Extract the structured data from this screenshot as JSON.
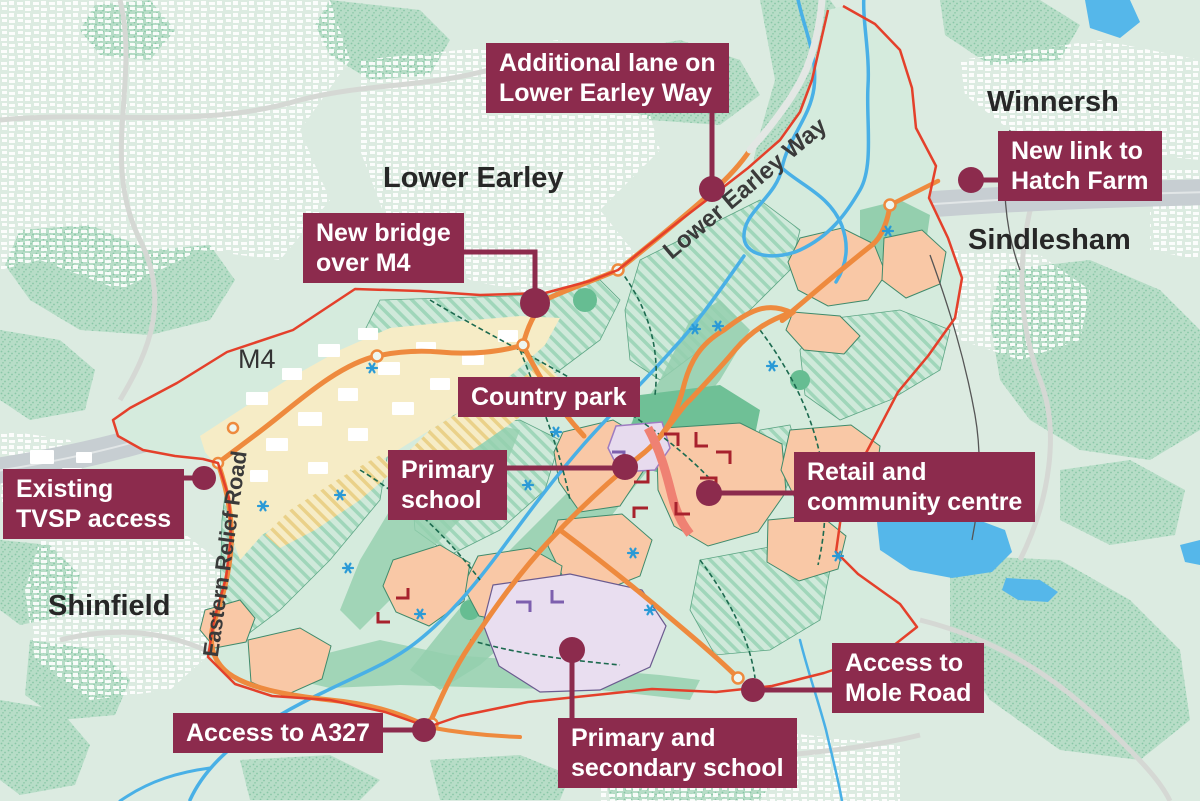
{
  "map_title": "Development site plan between Shinfield, Lower Earley, Winnersh and Sindlesham",
  "annotations": [
    {
      "id": "additional-lane",
      "lines": [
        "Additional lane on",
        "Lower Earley Way"
      ]
    },
    {
      "id": "new-bridge-m4",
      "lines": [
        "New bridge",
        "over M4"
      ]
    },
    {
      "id": "new-link-hatch-farm",
      "lines": [
        "New link to",
        "Hatch Farm"
      ]
    },
    {
      "id": "country-park",
      "lines": [
        "Country park"
      ]
    },
    {
      "id": "primary-school",
      "lines": [
        "Primary",
        "school"
      ]
    },
    {
      "id": "retail-community-centre",
      "lines": [
        "Retail and",
        "community centre"
      ]
    },
    {
      "id": "existing-tvsp-access",
      "lines": [
        "Existing",
        "TVSP access"
      ]
    },
    {
      "id": "access-a327",
      "lines": [
        "Access to A327"
      ]
    },
    {
      "id": "primary-secondary-school",
      "lines": [
        "Primary and",
        "secondary school"
      ]
    },
    {
      "id": "access-mole-road",
      "lines": [
        "Access to",
        "Mole Road"
      ]
    }
  ],
  "place_labels": [
    {
      "id": "lower-earley",
      "text": "Lower Earley"
    },
    {
      "id": "winnersh",
      "text": "Winnersh"
    },
    {
      "id": "sindlesham",
      "text": "Sindlesham"
    },
    {
      "id": "shinfield",
      "text": "Shinfield"
    },
    {
      "id": "m4",
      "text": "M4"
    }
  ],
  "road_labels": [
    {
      "id": "lower-earley-way",
      "text": "Lower Earley Way"
    },
    {
      "id": "eastern-relief-road",
      "text": "Eastern Relief Road"
    }
  ],
  "colors": {
    "callout_bg": "#8c2b4d",
    "callout_text": "#ffffff",
    "site_boundary": "#e4402b",
    "new_road": "#ee8a3e",
    "water": "#4fb3e8",
    "development_parcel": "#f9c8a6",
    "school_site": "#e7dbee",
    "green_space_hatch": "#a0d6ba",
    "business_park": "#f6ecc6",
    "motorway": "#c7ced2",
    "retail_street": "#a8222d"
  }
}
